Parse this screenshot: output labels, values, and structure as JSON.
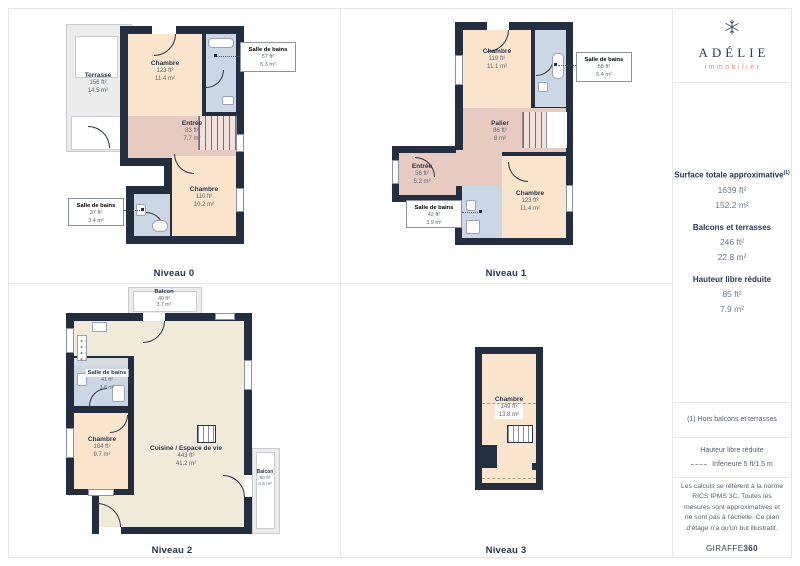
{
  "brand": {
    "name": "ADÉLIE",
    "tagline": "immobilier",
    "logo_icon": "snowflake-icon",
    "name_color": "#2d3752",
    "tagline_color": "#dd8f80"
  },
  "palette": {
    "wall": "#232e40",
    "bedroom": "#fbe4cc",
    "hall": "#e8cbc0",
    "bathroom": "#ccd7e6",
    "living": "#f0ead8",
    "outdoor": "#ececec"
  },
  "sidebar": {
    "metrics": {
      "title": "Surface totale approximative",
      "title_sup": "(1)",
      "total_ft": "1639 ft²",
      "total_m": "152.2 m²",
      "balconies_title": "Balcons et terrasses",
      "balconies_ft": "246 ft²",
      "balconies_m": "22.8 m²",
      "reduced_title": "Hauteur libre réduite",
      "reduced_ft": "85 ft²",
      "reduced_m": "7.9 m²"
    },
    "footnote": "(1) Hors balcons et terrasses",
    "legend": {
      "title": "Hauteur libre réduite",
      "label": "Inférieure 5 ft/1.5 m"
    },
    "legal": "Les calculs se réfèrent à la norme RICS IPMS 3C. Toutes les mesures sont approximatives et ne sont pas à l'échelle. Ce plan d'étage n'a qu'un but illustratif.",
    "credit_brand": "GIRAFFE",
    "credit_suffix": "360"
  },
  "levels": [
    {
      "name": "Niveau 0",
      "rooms": {
        "terrasse": {
          "name": "Terrasse",
          "ft": "156 ft²",
          "m": "14.5 m²"
        },
        "chambre1": {
          "name": "Chambre",
          "ft": "123 ft²",
          "m": "11.4 m²"
        },
        "sdb1": {
          "name": "Salle de bains",
          "ft": "57 ft²",
          "m": "5.3 m²"
        },
        "entree": {
          "name": "Entrée",
          "ft": "83 ft²",
          "m": "7.7 m²"
        },
        "chambre2": {
          "name": "Chambre",
          "ft": "110 ft²",
          "m": "10.2 m²"
        },
        "sdb2": {
          "name": "Salle de bains",
          "ft": "37 ft²",
          "m": "3.4 m²"
        }
      }
    },
    {
      "name": "Niveau 1",
      "rooms": {
        "chambre1": {
          "name": "Chambre",
          "ft": "119 ft²",
          "m": "11.1 m²"
        },
        "sdb1": {
          "name": "Salle de bains",
          "ft": "58 ft²",
          "m": "5.4 m²"
        },
        "palier": {
          "name": "Palier",
          "ft": "86 ft²",
          "m": "8 m²"
        },
        "entree": {
          "name": "Entrée",
          "ft": "56 ft²",
          "m": "5.2 m²"
        },
        "sdb2": {
          "name": "Salle de bains",
          "ft": "42 ft²",
          "m": "3.9 m²"
        },
        "chambre2": {
          "name": "Chambre",
          "ft": "123 ft²",
          "m": "11.4 m²"
        }
      }
    },
    {
      "name": "Niveau 2",
      "rooms": {
        "balcon1": {
          "name": "Balcon",
          "ft": "40 ft²",
          "m": "3.7 m²"
        },
        "sdb": {
          "name": "Salle de bains",
          "ft": "41 ft²",
          "m": "3.8 m²"
        },
        "chambre": {
          "name": "Chambre",
          "ft": "104 ft²",
          "m": "9.7 m²"
        },
        "cuisine": {
          "name": "Cuisine / Espace de vie",
          "ft": "443 ft²",
          "m": "41.2 m²"
        },
        "balcon2": {
          "name": "Balcon",
          "ft": "50 ft²",
          "m": "4.6 m²"
        }
      }
    },
    {
      "name": "Niveau 3",
      "rooms": {
        "chambre": {
          "name": "Chambre",
          "ft": "149 ft²",
          "m": "13.8 m²"
        }
      }
    }
  ]
}
